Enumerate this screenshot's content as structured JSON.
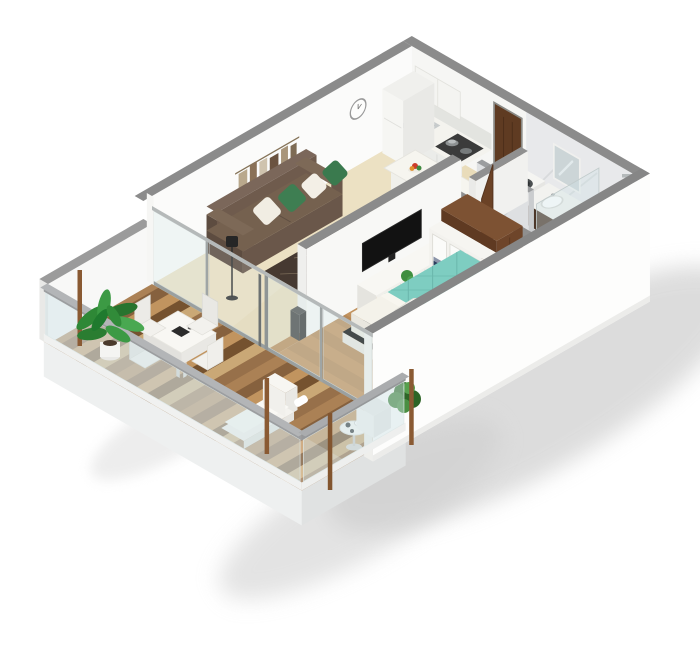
{
  "scene": {
    "type": "isometric-3d-floor-plan-render",
    "subject": "studio-apartment-with-balcony",
    "background": "#ffffff"
  },
  "palette": {
    "background": "#ffffff",
    "wall_top": "#8b8b8b",
    "wall_inner": "#fbfbfa",
    "wall_outer": "#fdfdfc",
    "tile_floor": "#e9dcba",
    "wood_floor": "#c2935f",
    "marble_floor": "#d9dadc",
    "marble_wall": "#e8e9eb",
    "rug": "#463931",
    "rug_line": "#8d7c66",
    "sofa": "#6a574a",
    "pillow_green": "#3e7e52",
    "pillow_white": "#f1ede3",
    "bed_teal": "#7ecdc1",
    "bed_white": "#f4f2ea",
    "door_wood": "#5f3b22",
    "wardrobe_wood": "#6e452a",
    "cabinet_white": "#f4f3ee",
    "stool_green": "#3f8a4f",
    "plant_green": "#3c9a44",
    "deck_wood": "#ab8155",
    "glass_tint": "#cfe3e6",
    "shower_tray": "#9a9c9d",
    "chrome": "#a9aeb0",
    "shadow": "#c6c6c6",
    "post_wood": "#8a5a33"
  },
  "rooms": [
    {
      "label": "living-room",
      "floor": "beige-tile",
      "items": [
        "sofa",
        "area-rug",
        "coffee-table",
        "floor-lamp",
        "wall-art",
        "wall-clock",
        "tv"
      ]
    },
    {
      "label": "kitchen",
      "floor": "beige-tile",
      "items": [
        "base-cabinets",
        "upper-cabinets",
        "cooktop",
        "sink",
        "fridge",
        "bar-counter",
        "bar-stools",
        "fruit-bowl"
      ]
    },
    {
      "label": "entrance-hall",
      "floor": "beige-tile",
      "items": [
        "entrance-door"
      ]
    },
    {
      "label": "bathroom",
      "floor": "marble",
      "items": [
        "washing-machine",
        "vanity-sink",
        "mirror",
        "toilet",
        "shower-tray",
        "shower-column",
        "shower-glass",
        "bathroom-door"
      ]
    },
    {
      "label": "bedroom",
      "floor": "wood",
      "items": [
        "double-bed",
        "pillows",
        "sideboard",
        "wardrobe",
        "towel-shelves",
        "potted-plant"
      ]
    },
    {
      "label": "balcony",
      "floor": "wood-deck",
      "items": [
        "dining-table",
        "dining-chairs",
        "chaise-lounge",
        "round-side-table",
        "large-potted-plant",
        "bush-planter",
        "glass-balustrade",
        "wooden-posts"
      ]
    }
  ]
}
